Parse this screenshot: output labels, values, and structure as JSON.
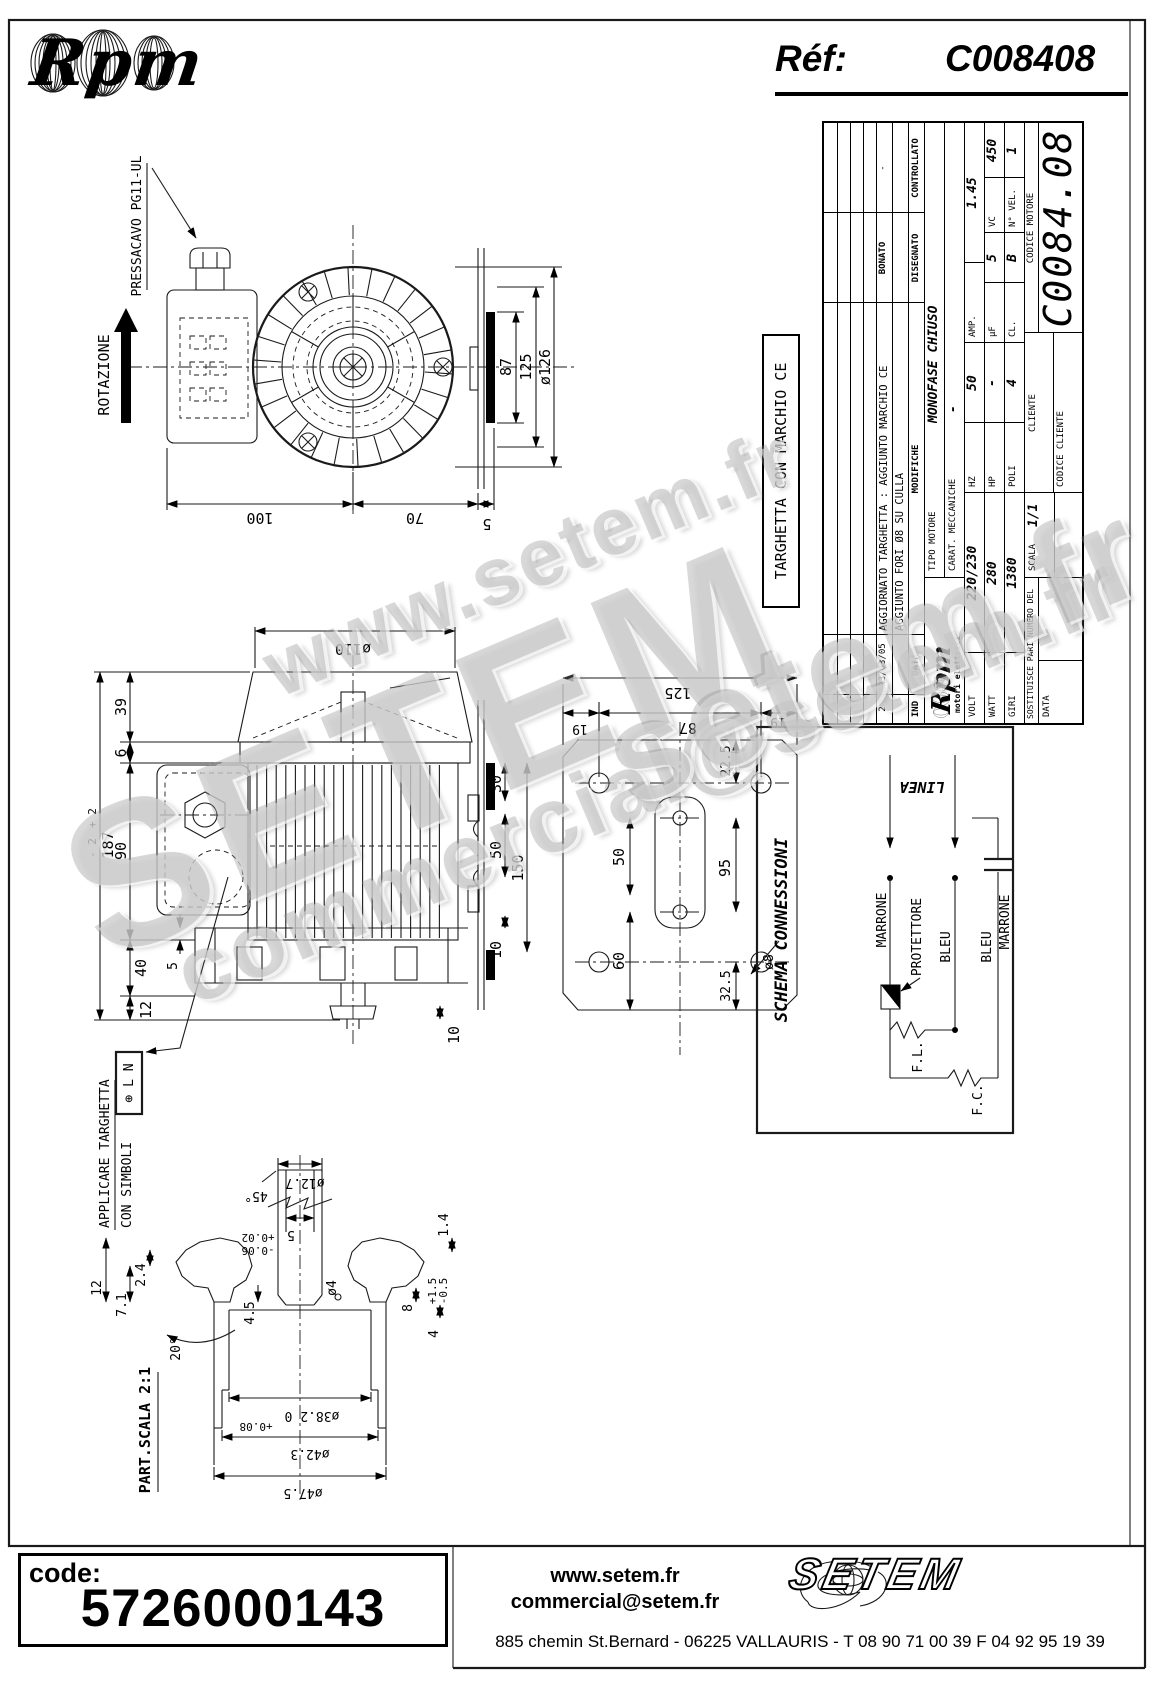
{
  "header": {
    "brand": "Rpm",
    "ref_label": "Réf:",
    "ref_value": "C008408"
  },
  "watermark": {
    "items": [
      "www.setem.fr",
      "SETEM",
      "commercial@setem.fr",
      "setem.fr"
    ]
  },
  "labels": {
    "rotazione": "ROTAZIONE",
    "pressacavo": "PRESSACAVO PG11-UL",
    "targhetta_ce": "TARGHETTA CON MARCHIO CE",
    "applicare_1": "APPLICARE TARGHETTA",
    "applicare_2": "CON SIMBOLI",
    "simboli": "⊕ L N",
    "part_scala": "PART.SCALA 2:1"
  },
  "dims": {
    "front": {
      "w100": "100",
      "w70": "70",
      "w5": "5",
      "h87": "87",
      "h125": "125",
      "d126": "ø126"
    },
    "side": {
      "d110": "ø110",
      "h39": "39",
      "h6": "6",
      "h90": "90",
      "h187": "187",
      "tp": "+ 2",
      "tm": "- 2",
      "h40": "40",
      "h12": "12",
      "g5": "5",
      "r30": "30",
      "r50": "50",
      "r150": "150",
      "r10": "10",
      "c10": "10"
    },
    "plate": {
      "w125": "125",
      "w87": "87",
      "w19l": "19",
      "w19r": "19",
      "v225": "22.5",
      "v50": "50",
      "v95": "95",
      "v60": "60",
      "v325": "32.5",
      "d8": "ø8"
    },
    "shaft": {
      "d127": "ø12.7",
      "ch45": "45°",
      "w5": "5",
      "t5p": "+0.02",
      "t5m": "-0.06",
      "l24": "2.4",
      "l12": "12",
      "l71": "7.1",
      "a20": "20°",
      "l45": "4.5",
      "d4": "ø4",
      "r8": "8",
      "t8p": "+1.5",
      "t8m": "-0.5",
      "r4": "4",
      "r14": "1.4",
      "d382": "ø38.2 0",
      "t382": "+0.08",
      "d423": "ø42.3",
      "d475": "ø47.5"
    }
  },
  "title_block": {
    "logo_text": "Rpm",
    "logo_sub": "motori elettrici",
    "rev": {
      "r2_ind": "2",
      "r2_data": "23/03/05",
      "r2_mod": "AGGIORNATO TARGHETTA : AGGIUNTO MARCHIO CE",
      "r2_dis": "BONATO",
      "r2_con": "-",
      "r1_mod": "AGGIUNTO FORI Ø8 SU CULLA"
    },
    "h_ind": "IND",
    "h_data": "DATA",
    "h_mod": "MODIFICHE",
    "h_dis": "DISEGNATO",
    "h_con": "CONTROLLATO",
    "tipo_label": "TIPO MOTORE",
    "tipo": "MONOFASE CHIUSO",
    "carat_label": "CARAT. MECCANICHE",
    "carat": "-",
    "volt_l": "VOLT",
    "volt": "220/230",
    "hz_l": "HZ",
    "hz": "50",
    "amp_l": "AMP.",
    "amp": "1.45",
    "watt_l": "WATT",
    "watt": "280",
    "hp_l": "HP",
    "hp": "-",
    "uf_l": "µF",
    "uf": "5",
    "vc_l": "VC",
    "vc": "450",
    "giri_l": "GIRI",
    "giri": "1380",
    "poli_l": "POLI",
    "poli": "4",
    "cl_l": "CL.",
    "cl": "B",
    "vel_l": "N° VEL.",
    "vel": "1",
    "sost": "SOSTITUISCE PARI NUMERO DEL",
    "data_l": "DATA",
    "scala_l": "SCALA",
    "scala": "1/1",
    "cliente_l": "CLIENTE",
    "cod_cli_l": "CODICE CLIENTE",
    "cod_mot_l": "CODICE MOTORE",
    "cod_mot": "C0084.08"
  },
  "schema": {
    "title": "SCHEMA CONNESSIONI",
    "linea": "LINEA",
    "marrone_1": "MARRONE",
    "protettore": "PROTETTORE",
    "bleu_1": "BLEU",
    "bleu_2": "BLEU",
    "marrone_2": "MARRONE",
    "fl": "F.L.",
    "fc": "F.C."
  },
  "footer": {
    "code_label": "code:",
    "code": "5726000143",
    "web": "www.setem.fr",
    "email": "commercial@setem.fr",
    "logo": "SETEM",
    "address": "885 chemin St.Bernard  -  06225 VALLAURIS  -  T 08 90 71 00 39   F 04 92 95 19 39"
  }
}
